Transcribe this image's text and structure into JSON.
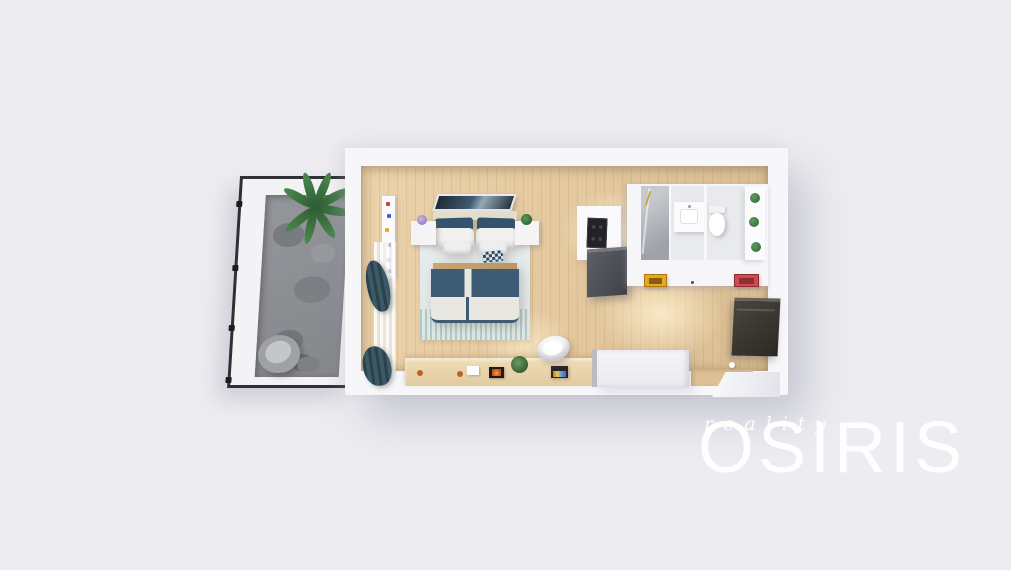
{
  "watermark": {
    "title": "OSIRIS",
    "subtitle": "reality"
  },
  "scene": {
    "type": "3d-floorplan-render",
    "rooms": [
      {
        "name": "balcony",
        "furniture": [
          "potted-palm",
          "lounge-chair",
          "side-stool"
        ]
      },
      {
        "name": "living-bedroom",
        "furniture": [
          "double-bed",
          "nightstand-left",
          "nightstand-right",
          "headboard-artwork",
          "area-rug",
          "bookshelf",
          "sheer-curtain",
          "teal-curtains",
          "sideboard-desk",
          "desk-chair",
          "laptop",
          "fireplace-artwork",
          "tv-panel"
        ]
      },
      {
        "name": "kitchen-hall",
        "furniture": [
          "cooktop",
          "tall-cabinet",
          "island-counter",
          "yellow-wall-art",
          "red-wall-art",
          "bathroom-door"
        ]
      },
      {
        "name": "bathroom",
        "furniture": [
          "glass-shower",
          "vanity-sink",
          "toilet",
          "plant-shelf"
        ]
      }
    ]
  },
  "colors": {
    "background": "#EDEDF1",
    "walls": "#F7F7FA",
    "wood_floor": "#E3C79E",
    "balcony_stone": "#8A8C91",
    "bedding_navy": "#3E5B76",
    "curtains_teal": "#2F4C58",
    "artwork_yellow": "#E5A81E",
    "artwork_red": "#D04A50",
    "tv_panel": "#3B3734",
    "plant_green": "#3F7A43",
    "watermark_white": "#FFFFFF"
  }
}
